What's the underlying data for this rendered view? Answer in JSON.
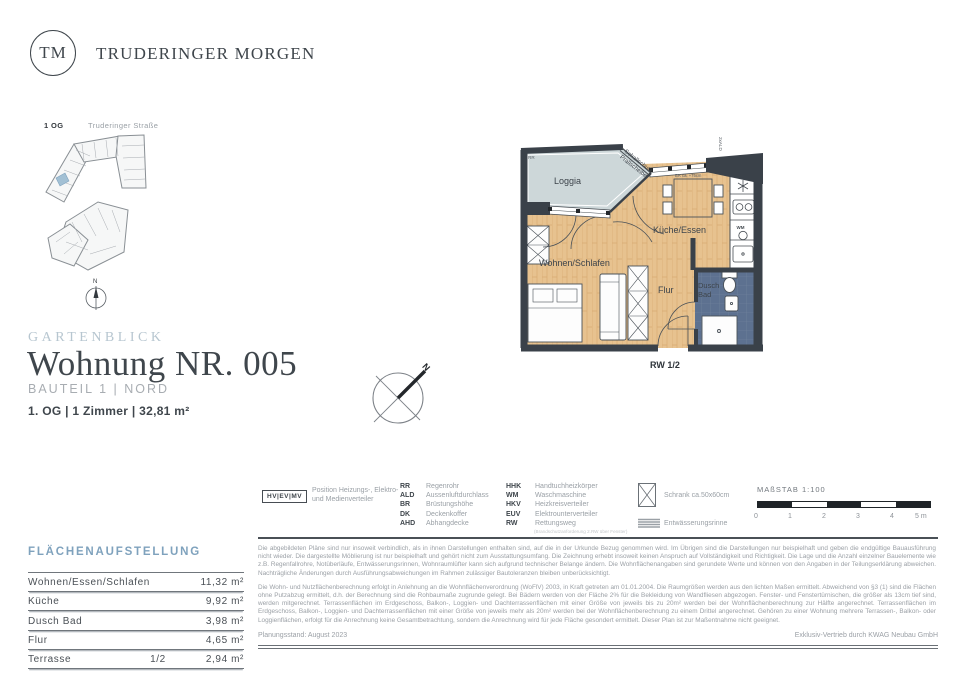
{
  "brand": {
    "initials": "TM",
    "name": "TRUDERINGER MORGEN"
  },
  "site_plan": {
    "floor": "1 OG",
    "street": "Truderinger Straße",
    "north": "N"
  },
  "title_block": {
    "project": "GARTENBLICK",
    "title": "Wohnung NR. 005",
    "building": "BAUTEIL 1 | NORD",
    "details": "1. OG | 1 Zimmer | 32,81 m²"
  },
  "plan": {
    "rooms": {
      "loggia": "Loggia",
      "kitchen": "Küche/Essen",
      "living": "Wohnen/Schlafen",
      "hall": "Flur",
      "bath1": "Dusch",
      "bath2": "Bad"
    },
    "notes": {
      "sound1": "Schallschutz",
      "sound2": "Prallscheibe",
      "ald": "2xALD",
      "rr": "RR",
      "br": "BR ca. +75cm",
      "wm": "WM",
      "escape": "RW 1/2",
      "north": "N"
    }
  },
  "legend": {
    "hv_code": "HV|EV|MV",
    "hv_label": "Position Heizungs-, Elektro- und Medienverteiler",
    "col1": [
      {
        "code": "RR",
        "term": "Regenrohr"
      },
      {
        "code": "ALD",
        "term": "Aussenluftdurchlass"
      },
      {
        "code": "BR",
        "term": "Brüstungshöhe"
      },
      {
        "code": "DK",
        "term": "Deckenkoffer"
      },
      {
        "code": "AHD",
        "term": "Abhangdecke"
      }
    ],
    "col2": [
      {
        "code": "HHK",
        "term": "Handtuchheizkörper"
      },
      {
        "code": "WM",
        "term": "Waschmaschine"
      },
      {
        "code": "HKV",
        "term": "Heizkreisverteiler"
      },
      {
        "code": "EUV",
        "term": "Elektrounterverteiler"
      },
      {
        "code": "RW",
        "term": "Rettungsweg"
      }
    ],
    "rw_note": "(Brandschutzanforderung 2.RW über Fenster)",
    "schrank": "Schrank ca.50x60cm",
    "rinne": "Entwässerungsrinne"
  },
  "scale": {
    "label": "MAßSTAB 1:100",
    "ticks": [
      "0",
      "1",
      "2",
      "3",
      "4",
      "5 m"
    ]
  },
  "areas": {
    "heading": "FLÄCHENAUFSTELLUNG",
    "rows": [
      {
        "label": "Wohnen/Essen/Schlafen",
        "fraction": "",
        "value": "11,32 m²"
      },
      {
        "label": "Küche",
        "fraction": "",
        "value": "9,92 m²"
      },
      {
        "label": "Dusch Bad",
        "fraction": "",
        "value": "3,98 m²"
      },
      {
        "label": "Flur",
        "fraction": "",
        "value": "4,65 m²"
      },
      {
        "label": "Terrasse",
        "fraction": "1/2",
        "value": "2,94 m²"
      }
    ]
  },
  "disclaimer": {
    "p1": "Die abgebildeten Pläne sind nur insoweit verbindlich, als in ihnen Darstellungen enthalten sind, auf die in der Urkunde Bezug genommen wird. Im Übrigen sind die Darstellungen nur beispielhaft und geben die endgültige Bauausführung nicht wieder. Die dargestellte Möblierung ist nur beispielhaft und gehört nicht zum Ausstattungsumfang. Die Zeichnung erhebt insoweit keinen Anspruch auf Vollständigkeit und Richtigkeit. Die Lage und die Anzahl einzelner Bauelemente wie z.B. Regenfallrohre, Notüberläufe, Entwässerungsrinnen, Wohnraumlüfter kann sich aufgrund technischer Belange ändern. Die Wohnflächenangaben sind gerundete Werte und können von den Angaben in der Teilungserklärung abweichen. Nachträgliche Änderungen durch Ausführungsabweichungen im Rahmen zulässiger Bautoleranzen bleiben unberücksichtigt.",
    "p2": "Die Wohn- und Nutzflächenberechnung erfolgt in Anlehnung an die Wohnflächenverordnung (WoFlV) 2003, in Kraft getreten am 01.01.2004. Die Raumgrößen werden aus den lichten Maßen ermittelt. Abweichend von §3 (1) sind die Flächen ohne Putzabzug ermittelt, d.h. der Berechnung sind die Rohbaumaße zugrunde gelegt. Bei Bädern werden von der Fläche 2% für die Bekleidung von Wandfliesen abgezogen. Fenster- und Fenstertürnischen, die größer als 13cm tief sind, werden mitgerechnet. Terrassenflächen im Erdgeschoss, Balkon-, Loggien- und Dachterrassenflächen mit einer Größe von jeweils bis zu 20m² werden bei der Wohnflächenberechnung zur Hälfte angerechnet. Terrassenflächen im Erdgeschoss, Balkon-, Loggien- und Dachterrassenflächen mit einer Größe von jeweils mehr als 20m² werden bei der Wohnflächenberechnung zu einem Drittel angerechnet. Gehören zu einer Wohnung mehrere Terrassen-, Balkon- oder Loggienflächen, erfolgt für die Anrechnung keine Gesamtbetrachtung, sondern die Anrechnung wird für jede Fläche gesondert ermittelt. Dieser Plan ist zur Maßentnahme nicht geeignet.",
    "plan_note_colors": {
      "wood": "#e7c28f",
      "loggia": "#cdd7d9",
      "bath": "#5d7190",
      "wall": "#3a4149",
      "accent_blue": "#7fa2bd"
    }
  },
  "footer": {
    "left": "Planungsstand: August 2023",
    "right": "Exklusiv-Vertrieb durch KWAG Neubau GmbH"
  }
}
